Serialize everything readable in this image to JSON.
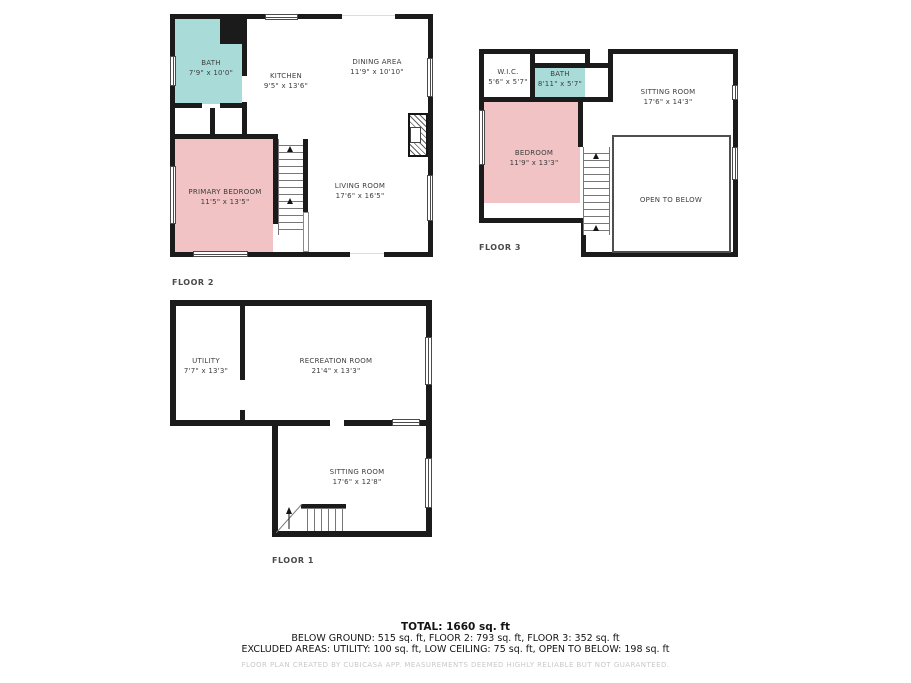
{
  "colors": {
    "wall": "#1b1b1b",
    "bath_fill": "#a9dbd9",
    "bedroom_fill": "#f1c3c5",
    "label_text": "#3d3d3d",
    "credit_text": "#c9c9c9"
  },
  "floors": {
    "floor2": {
      "label": "FLOOR 2",
      "rooms": {
        "bath": {
          "name": "BATH",
          "dims": "7'9\" x 10'0\""
        },
        "kitchen": {
          "name": "KITCHEN",
          "dims": "9'5\" x 13'6\""
        },
        "dining": {
          "name": "DINING AREA",
          "dims": "11'9\" x 10'10\""
        },
        "primary_bedroom": {
          "name": "PRIMARY BEDROOM",
          "dims": "11'5\" x 13'5\""
        },
        "living": {
          "name": "LIVING ROOM",
          "dims": "17'6\" x 16'5\""
        }
      }
    },
    "floor3": {
      "label": "FLOOR 3",
      "rooms": {
        "wic": {
          "name": "W.I.C.",
          "dims": "5'6\" x 5'7\""
        },
        "bath": {
          "name": "BATH",
          "dims": "8'11\" x 5'7\""
        },
        "sitting": {
          "name": "SITTING ROOM",
          "dims": "17'6\" x 14'3\""
        },
        "bedroom": {
          "name": "BEDROOM",
          "dims": "11'9\" x 13'3\""
        },
        "open_below": {
          "name": "OPEN TO BELOW"
        }
      }
    },
    "floor1": {
      "label": "FLOOR 1",
      "rooms": {
        "utility": {
          "name": "UTILITY",
          "dims": "7'7\" x 13'3\""
        },
        "recreation": {
          "name": "RECREATION ROOM",
          "dims": "21'4\" x 13'3\""
        },
        "sitting": {
          "name": "SITTING ROOM",
          "dims": "17'6\" x 12'8\""
        }
      }
    }
  },
  "summary": {
    "total": "TOTAL: 1660 sq. ft",
    "by_floor": "BELOW GROUND: 515 sq. ft, FLOOR 2: 793 sq. ft, FLOOR 3: 352 sq. ft",
    "excluded": "EXCLUDED AREAS: UTILITY: 100 sq. ft, LOW CEILING: 75 sq. ft, OPEN TO BELOW: 198 sq. ft"
  },
  "credit": "FLOOR PLAN CREATED BY CUBICASA APP. MEASUREMENTS DEEMED HIGHLY RELIABLE BUT NOT GUARANTEED."
}
